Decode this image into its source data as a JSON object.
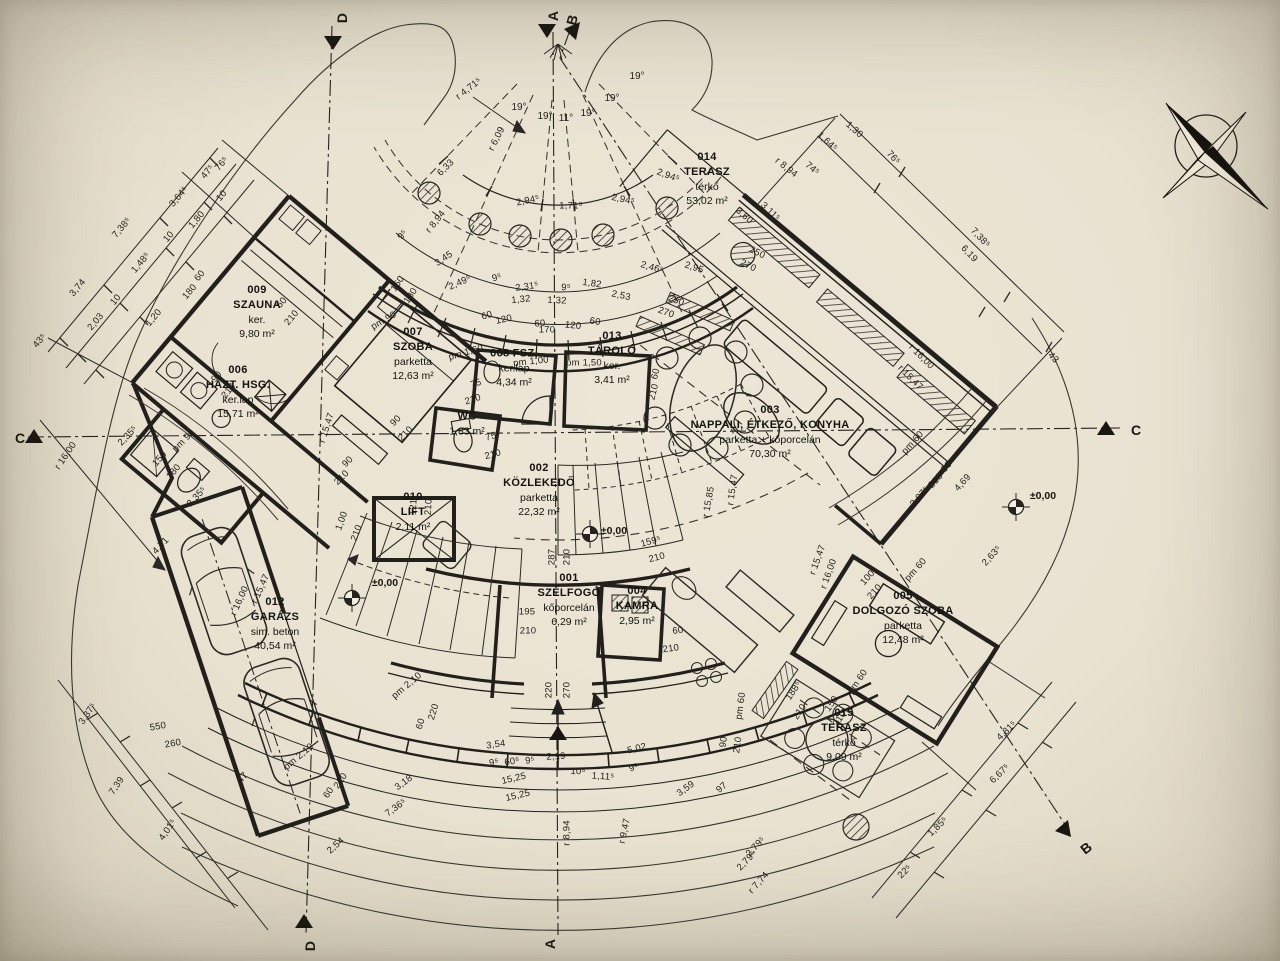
{
  "sheet": {
    "kind": "architectural floor plan",
    "language": "Hungarian"
  },
  "rooms": [
    {
      "lines": [
        "009",
        "SZAUNA",
        "ker.",
        "9,80 m²"
      ],
      "x": 257,
      "y": 312
    },
    {
      "lines": [
        "006",
        "HÁZT. HSG.",
        "ker.lap",
        "15,71 m²"
      ],
      "x": 238,
      "y": 392
    },
    {
      "lines": [
        "007",
        "SZOBA",
        "parketta",
        "12,63 m²"
      ],
      "x": 413,
      "y": 354
    },
    {
      "lines": [
        "008 FSZ.",
        "ker.lap",
        "4,34 m²"
      ],
      "x": 514,
      "y": 368
    },
    {
      "lines": [
        "WC",
        "1,83 m²"
      ],
      "x": 467,
      "y": 424
    },
    {
      "lines": [
        "013",
        "TÁROLÓ",
        "ker.",
        "3,41 m²"
      ],
      "x": 612,
      "y": 358
    },
    {
      "lines": [
        "014",
        "TERASZ",
        "térkő",
        "53,02 m²"
      ],
      "x": 707,
      "y": 179
    },
    {
      "lines": [
        "003",
        "NAPPALI, ÉTKEZŐ, KONYHA",
        "parketta + kőporcelán",
        "70,30 m²"
      ],
      "x": 770,
      "y": 432
    },
    {
      "lines": [
        "002",
        "KÖZLEKEDŐ",
        "parketta",
        "22,32 m²"
      ],
      "x": 539,
      "y": 490
    },
    {
      "lines": [
        "010",
        "LIFT",
        "2,11 m²"
      ],
      "x": 413,
      "y": 512
    },
    {
      "lines": [
        "001",
        "SZÉLFOGÓ",
        "kőporcelán",
        "6,29 m²"
      ],
      "x": 569,
      "y": 600
    },
    {
      "lines": [
        "004",
        "KAMRA",
        "2,95 m²"
      ],
      "x": 637,
      "y": 606
    },
    {
      "lines": [
        "012",
        "GARÁZS",
        "sim. beton",
        "40,54 m²"
      ],
      "x": 275,
      "y": 624
    },
    {
      "lines": [
        "005",
        "DOLGOZÓ SZOBA",
        "parketta",
        "12,48 m²"
      ],
      "x": 903,
      "y": 618
    },
    {
      "lines": [
        "015",
        "TERASZ",
        "térkő",
        "9,09 m²"
      ],
      "x": 844,
      "y": 735
    }
  ],
  "angle_labels": [
    {
      "t": "19°",
      "x": 519,
      "y": 108,
      "r": 0
    },
    {
      "t": "19°",
      "x": 545,
      "y": 117,
      "r": 0
    },
    {
      "t": "11°",
      "x": 566,
      "y": 119,
      "r": 0
    },
    {
      "t": "19°",
      "x": 588,
      "y": 114,
      "r": 0
    },
    {
      "t": "19°",
      "x": 612,
      "y": 99,
      "r": 0
    },
    {
      "t": "19°",
      "x": 637,
      "y": 77,
      "r": 0
    }
  ],
  "dim_labels": [
    {
      "t": "7,38⁵",
      "x": 122,
      "y": 228,
      "r": -50
    },
    {
      "t": "3,74",
      "x": 78,
      "y": 288,
      "r": -50
    },
    {
      "t": "2,03",
      "x": 96,
      "y": 322,
      "r": -50
    },
    {
      "t": "10",
      "x": 116,
      "y": 300,
      "r": -50
    },
    {
      "t": "1,48⁵",
      "x": 141,
      "y": 263,
      "r": -50
    },
    {
      "t": "10",
      "x": 169,
      "y": 237,
      "r": -50
    },
    {
      "t": "3,64⁵",
      "x": 179,
      "y": 197,
      "r": -50
    },
    {
      "t": "1,80",
      "x": 197,
      "y": 220,
      "r": -50
    },
    {
      "t": "10",
      "x": 222,
      "y": 196,
      "r": -50
    },
    {
      "t": "47⁵",
      "x": 208,
      "y": 172,
      "r": -50
    },
    {
      "t": "76⁵",
      "x": 222,
      "y": 164,
      "r": -50
    },
    {
      "t": "1,20",
      "x": 154,
      "y": 318,
      "r": -50
    },
    {
      "t": "43⁵",
      "x": 40,
      "y": 341,
      "r": -50
    },
    {
      "t": "60",
      "x": 200,
      "y": 276,
      "r": -50
    },
    {
      "t": "180",
      "x": 190,
      "y": 292,
      "r": -50
    },
    {
      "t": "90",
      "x": 217,
      "y": 377,
      "r": -50
    },
    {
      "t": "210",
      "x": 229,
      "y": 391,
      "r": -50
    },
    {
      "t": "60",
      "x": 282,
      "y": 303,
      "r": -50
    },
    {
      "t": "210",
      "x": 292,
      "y": 318,
      "r": -50
    },
    {
      "t": "pm 90",
      "x": 184,
      "y": 441,
      "r": -45
    },
    {
      "t": "150",
      "x": 160,
      "y": 459,
      "r": -50
    },
    {
      "t": "180",
      "x": 174,
      "y": 472,
      "r": -50
    },
    {
      "t": "2,35⁵",
      "x": 128,
      "y": 436,
      "r": -47
    },
    {
      "t": "2,35⁵",
      "x": 197,
      "y": 497,
      "r": -47
    },
    {
      "t": "4,71",
      "x": 161,
      "y": 546,
      "r": -47
    },
    {
      "t": "r 16,00",
      "x": 66,
      "y": 456,
      "r": -56
    },
    {
      "t": "r 15,47",
      "x": 327,
      "y": 428,
      "r": -72
    },
    {
      "t": "90",
      "x": 396,
      "y": 421,
      "r": -45
    },
    {
      "t": "210",
      "x": 406,
      "y": 434,
      "r": -45
    },
    {
      "t": "90",
      "x": 348,
      "y": 462,
      "r": -45
    },
    {
      "t": "210",
      "x": 342,
      "y": 478,
      "r": -45
    },
    {
      "t": "1,00",
      "x": 342,
      "y": 521,
      "r": -70
    },
    {
      "t": "210",
      "x": 357,
      "y": 533,
      "r": -70
    },
    {
      "t": "121⁵",
      "x": 414,
      "y": 505,
      "r": -86
    },
    {
      "t": "210",
      "x": 429,
      "y": 507,
      "r": -86
    },
    {
      "t": "r 4,71⁵",
      "x": 469,
      "y": 89,
      "r": -38
    },
    {
      "t": "r 6,09",
      "x": 497,
      "y": 139,
      "r": -63
    },
    {
      "t": "6,33",
      "x": 446,
      "y": 168,
      "r": -45
    },
    {
      "t": "r 8,94",
      "x": 436,
      "y": 222,
      "r": -52
    },
    {
      "t": "9⁵",
      "x": 403,
      "y": 235,
      "r": -52
    },
    {
      "t": "3,45",
      "x": 444,
      "y": 259,
      "r": -35
    },
    {
      "t": "2,49⁵",
      "x": 460,
      "y": 283,
      "r": -24
    },
    {
      "t": "9⁵",
      "x": 497,
      "y": 278,
      "r": -16
    },
    {
      "t": "2,31⁵",
      "x": 527,
      "y": 287,
      "r": -8
    },
    {
      "t": "1,32",
      "x": 521,
      "y": 300,
      "r": -6
    },
    {
      "t": "1,32",
      "x": 557,
      "y": 301,
      "r": 2
    },
    {
      "t": "9⁵",
      "x": 566,
      "y": 288,
      "r": 2
    },
    {
      "t": "1,82",
      "x": 592,
      "y": 284,
      "r": 8
    },
    {
      "t": "2,53",
      "x": 621,
      "y": 296,
      "r": 12
    },
    {
      "t": "2,46⁵",
      "x": 652,
      "y": 268,
      "r": 16
    },
    {
      "t": "2,95",
      "x": 694,
      "y": 268,
      "r": 18
    },
    {
      "t": "150",
      "x": 398,
      "y": 284,
      "r": -56
    },
    {
      "t": "180",
      "x": 411,
      "y": 296,
      "r": -56
    },
    {
      "t": "pm 90",
      "x": 384,
      "y": 321,
      "r": -30
    },
    {
      "t": "60",
      "x": 487,
      "y": 316,
      "r": -16
    },
    {
      "t": "120",
      "x": 504,
      "y": 320,
      "r": -12
    },
    {
      "t": "60",
      "x": 540,
      "y": 324,
      "r": -4
    },
    {
      "t": "170",
      "x": 547,
      "y": 330,
      "r": 0
    },
    {
      "t": "120",
      "x": 573,
      "y": 326,
      "r": 6
    },
    {
      "t": "60",
      "x": 595,
      "y": 322,
      "r": 10
    },
    {
      "t": "250",
      "x": 676,
      "y": 301,
      "r": 20
    },
    {
      "t": "270",
      "x": 666,
      "y": 313,
      "r": 20
    },
    {
      "t": "2,94⁵",
      "x": 528,
      "y": 201,
      "r": -12
    },
    {
      "t": "1,71⁵",
      "x": 571,
      "y": 206,
      "r": 0
    },
    {
      "t": "2,94⁵",
      "x": 623,
      "y": 200,
      "r": 12
    },
    {
      "t": "2,94⁵",
      "x": 668,
      "y": 176,
      "r": 20
    },
    {
      "t": "1,64⁵",
      "x": 827,
      "y": 142,
      "r": 42
    },
    {
      "t": "1,30",
      "x": 854,
      "y": 130,
      "r": 42
    },
    {
      "t": "74⁵",
      "x": 812,
      "y": 169,
      "r": 40
    },
    {
      "t": "r 8,94",
      "x": 786,
      "y": 168,
      "r": 38
    },
    {
      "t": "3,60",
      "x": 744,
      "y": 216,
      "r": 42
    },
    {
      "t": "3,11⁵",
      "x": 770,
      "y": 212,
      "r": 44
    },
    {
      "t": "250",
      "x": 757,
      "y": 253,
      "r": 26
    },
    {
      "t": "270",
      "x": 748,
      "y": 266,
      "r": 26
    },
    {
      "t": "76⁵",
      "x": 893,
      "y": 158,
      "r": 47
    },
    {
      "t": "7,38⁵",
      "x": 980,
      "y": 238,
      "r": 47
    },
    {
      "t": "6,19",
      "x": 969,
      "y": 254,
      "r": 47
    },
    {
      "t": "43",
      "x": 1053,
      "y": 358,
      "r": 47
    },
    {
      "t": "r 16,00",
      "x": 921,
      "y": 357,
      "r": 45
    },
    {
      "t": "r 15,47",
      "x": 910,
      "y": 378,
      "r": 45
    },
    {
      "t": "90",
      "x": 947,
      "y": 467,
      "r": -48
    },
    {
      "t": "210",
      "x": 936,
      "y": 481,
      "r": -48
    },
    {
      "t": "4,69",
      "x": 963,
      "y": 483,
      "r": -48
    },
    {
      "t": "2,07⁵",
      "x": 920,
      "y": 497,
      "r": -48
    },
    {
      "t": "2,63⁵",
      "x": 992,
      "y": 556,
      "r": -48
    },
    {
      "t": "pm 60",
      "x": 913,
      "y": 443,
      "r": -48
    },
    {
      "t": "pm 60",
      "x": 916,
      "y": 570,
      "r": -48
    },
    {
      "t": "r 15,47",
      "x": 733,
      "y": 490,
      "r": -82
    },
    {
      "t": "r 15,85",
      "x": 709,
      "y": 502,
      "r": -80
    },
    {
      "t": "r 15,47",
      "x": 818,
      "y": 560,
      "r": -70
    },
    {
      "t": "r 16,00",
      "x": 829,
      "y": 574,
      "r": -70
    },
    {
      "t": "100",
      "x": 868,
      "y": 578,
      "r": -48
    },
    {
      "t": "210",
      "x": 875,
      "y": 592,
      "r": -48
    },
    {
      "t": "60",
      "x": 656,
      "y": 374,
      "r": -76
    },
    {
      "t": "210",
      "x": 654,
      "y": 392,
      "r": -76
    },
    {
      "t": "60",
      "x": 678,
      "y": 631,
      "r": -8
    },
    {
      "t": "210",
      "x": 671,
      "y": 649,
      "r": -8
    },
    {
      "t": "pm 60",
      "x": 741,
      "y": 706,
      "r": -82
    },
    {
      "t": "90",
      "x": 724,
      "y": 742,
      "r": -82
    },
    {
      "t": "210",
      "x": 738,
      "y": 745,
      "r": -82
    },
    {
      "t": "195",
      "x": 527,
      "y": 612,
      "r": 0
    },
    {
      "t": "210",
      "x": 528,
      "y": 631,
      "r": 0
    },
    {
      "t": "220",
      "x": 549,
      "y": 690,
      "r": -90
    },
    {
      "t": "270",
      "x": 567,
      "y": 690,
      "r": -90
    },
    {
      "t": "287",
      "x": 552,
      "y": 557,
      "r": -90
    },
    {
      "t": "210",
      "x": 567,
      "y": 557,
      "r": -90
    },
    {
      "t": "159⁵",
      "x": 651,
      "y": 542,
      "r": -15
    },
    {
      "t": "210",
      "x": 657,
      "y": 558,
      "r": -15
    },
    {
      "t": "pm 1,60",
      "x": 466,
      "y": 353,
      "r": -16
    },
    {
      "t": "pm 1,00",
      "x": 531,
      "y": 362,
      "r": -6
    },
    {
      "t": "pm 1,50",
      "x": 584,
      "y": 363,
      "r": 0
    },
    {
      "t": "75",
      "x": 476,
      "y": 384,
      "r": -18
    },
    {
      "t": "210",
      "x": 473,
      "y": 400,
      "r": -18
    },
    {
      "t": "75",
      "x": 491,
      "y": 437,
      "r": -15
    },
    {
      "t": "210",
      "x": 493,
      "y": 455,
      "r": -15
    },
    {
      "t": "pm 2,10",
      "x": 407,
      "y": 686,
      "r": -40
    },
    {
      "t": "pm 2,10",
      "x": 299,
      "y": 757,
      "r": -40
    },
    {
      "t": "r 15,47",
      "x": 261,
      "y": 589,
      "r": -66
    },
    {
      "t": "r 16,00",
      "x": 240,
      "y": 601,
      "r": -66
    },
    {
      "t": "550",
      "x": 158,
      "y": 727,
      "r": -10
    },
    {
      "t": "260",
      "x": 173,
      "y": 744,
      "r": -10
    },
    {
      "t": "47",
      "x": 243,
      "y": 778,
      "r": -50
    },
    {
      "t": "220",
      "x": 434,
      "y": 712,
      "r": -73
    },
    {
      "t": "60",
      "x": 421,
      "y": 724,
      "r": -73
    },
    {
      "t": "220",
      "x": 341,
      "y": 781,
      "r": -56
    },
    {
      "t": "60",
      "x": 329,
      "y": 793,
      "r": -56
    },
    {
      "t": "3,37⁵",
      "x": 88,
      "y": 714,
      "r": -56
    },
    {
      "t": "7,39",
      "x": 117,
      "y": 786,
      "r": -56
    },
    {
      "t": "4,01⁵",
      "x": 168,
      "y": 830,
      "r": -56
    },
    {
      "t": "2,54",
      "x": 336,
      "y": 846,
      "r": -42
    },
    {
      "t": "3,18",
      "x": 404,
      "y": 783,
      "r": -36
    },
    {
      "t": "7,36⁵",
      "x": 396,
      "y": 808,
      "r": -36
    },
    {
      "t": "15,25",
      "x": 514,
      "y": 779,
      "r": -13
    },
    {
      "t": "15,25",
      "x": 518,
      "y": 796,
      "r": -13
    },
    {
      "t": "3,54",
      "x": 496,
      "y": 745,
      "r": -8
    },
    {
      "t": "9⁵",
      "x": 494,
      "y": 763,
      "r": -8
    },
    {
      "t": "60⁵",
      "x": 512,
      "y": 762,
      "r": -8
    },
    {
      "t": "9⁵",
      "x": 530,
      "y": 761,
      "r": -6
    },
    {
      "t": "2,19",
      "x": 556,
      "y": 757,
      "r": -3
    },
    {
      "t": "10⁵",
      "x": 578,
      "y": 772,
      "r": 2
    },
    {
      "t": "1,11⁵",
      "x": 603,
      "y": 777,
      "r": 4
    },
    {
      "t": "r 8,94",
      "x": 567,
      "y": 833,
      "r": -90
    },
    {
      "t": "r 9,47",
      "x": 625,
      "y": 831,
      "r": -78
    },
    {
      "t": "5,02",
      "x": 637,
      "y": 749,
      "r": -14
    },
    {
      "t": "9⁵",
      "x": 634,
      "y": 768,
      "r": -20
    },
    {
      "t": "3,59",
      "x": 686,
      "y": 789,
      "r": -36
    },
    {
      "t": "97",
      "x": 722,
      "y": 788,
      "r": -40
    },
    {
      "t": "2,79⁵",
      "x": 756,
      "y": 847,
      "r": -46
    },
    {
      "t": "2,79⁵",
      "x": 747,
      "y": 861,
      "r": -46
    },
    {
      "t": "r 7,74",
      "x": 759,
      "y": 883,
      "r": -48
    },
    {
      "t": "22⁵",
      "x": 905,
      "y": 872,
      "r": -44
    },
    {
      "t": "1,85⁵",
      "x": 938,
      "y": 827,
      "r": -44
    },
    {
      "t": "6,67⁵",
      "x": 1000,
      "y": 774,
      "r": -44
    },
    {
      "t": "4,81⁵",
      "x": 1007,
      "y": 731,
      "r": -44
    },
    {
      "t": "pm 60",
      "x": 858,
      "y": 682,
      "r": -56
    },
    {
      "t": "188⁵",
      "x": 794,
      "y": 691,
      "r": -56
    },
    {
      "t": "210",
      "x": 800,
      "y": 712,
      "r": -56
    },
    {
      "t": "150",
      "x": 832,
      "y": 704,
      "r": -56
    },
    {
      "t": "210",
      "x": 840,
      "y": 719,
      "r": -56
    }
  ],
  "elevation_markers": [
    {
      "t": "±0,00",
      "x": 385,
      "y": 583
    },
    {
      "t": "±0,00",
      "x": 614,
      "y": 531
    },
    {
      "t": "±0,00",
      "x": 1043,
      "y": 496
    }
  ],
  "section_markers": [
    {
      "t": "C",
      "x": 14,
      "y": 430,
      "r": 0
    },
    {
      "t": "C",
      "x": 1130,
      "y": 422,
      "r": 0
    },
    {
      "t": "A",
      "x": 547,
      "y": 8,
      "r": -90
    },
    {
      "t": "B",
      "x": 566,
      "y": 12,
      "r": -75
    },
    {
      "t": "D",
      "x": 336,
      "y": 10,
      "r": -90
    },
    {
      "t": "A",
      "x": 544,
      "y": 936,
      "r": -90
    },
    {
      "t": "D",
      "x": 304,
      "y": 938,
      "r": -90
    },
    {
      "t": "B",
      "x": 1080,
      "y": 840,
      "r": -38
    }
  ],
  "colors": {
    "paper": "#e9e2d1",
    "ink": "#26241f"
  }
}
